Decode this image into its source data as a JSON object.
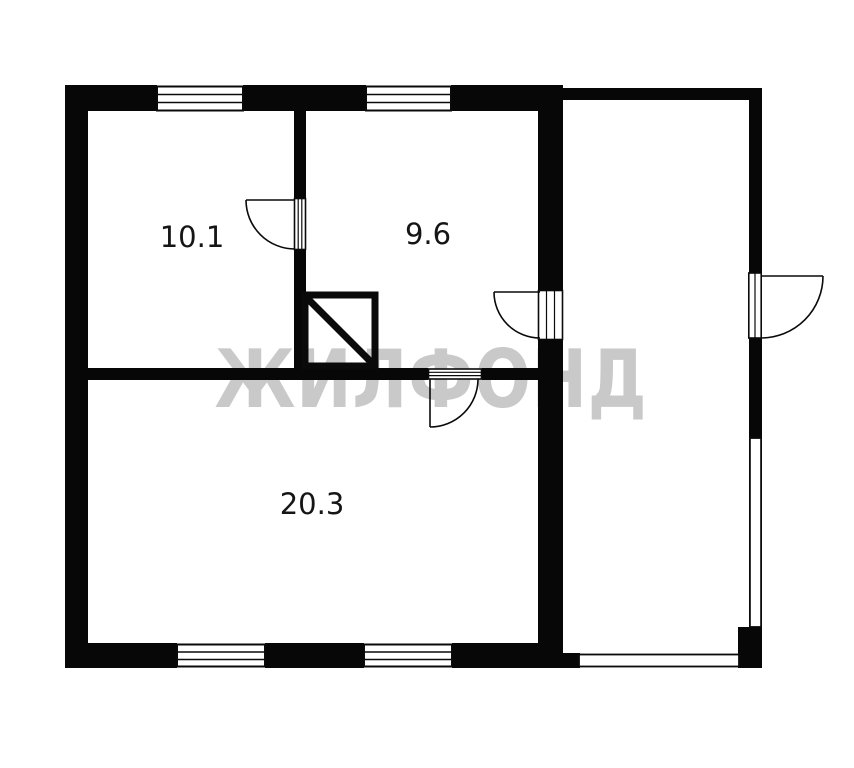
{
  "diagram": {
    "type": "floor-plan",
    "description_visible_elements": "floor plan with three labeled rooms, veranda, four windows, four doors, stove"
  },
  "watermark": {
    "text": "ЖИЛФОНД",
    "color": "#c9c9c9"
  },
  "colors": {
    "wall": "#070707",
    "background": "#ffffff",
    "label": "#151515"
  },
  "rooms": [
    {
      "id": "room-top-left",
      "area_label": "10.1"
    },
    {
      "id": "room-top-middle",
      "area_label": "9.6"
    },
    {
      "id": "room-bottom",
      "area_label": "20.3"
    }
  ]
}
